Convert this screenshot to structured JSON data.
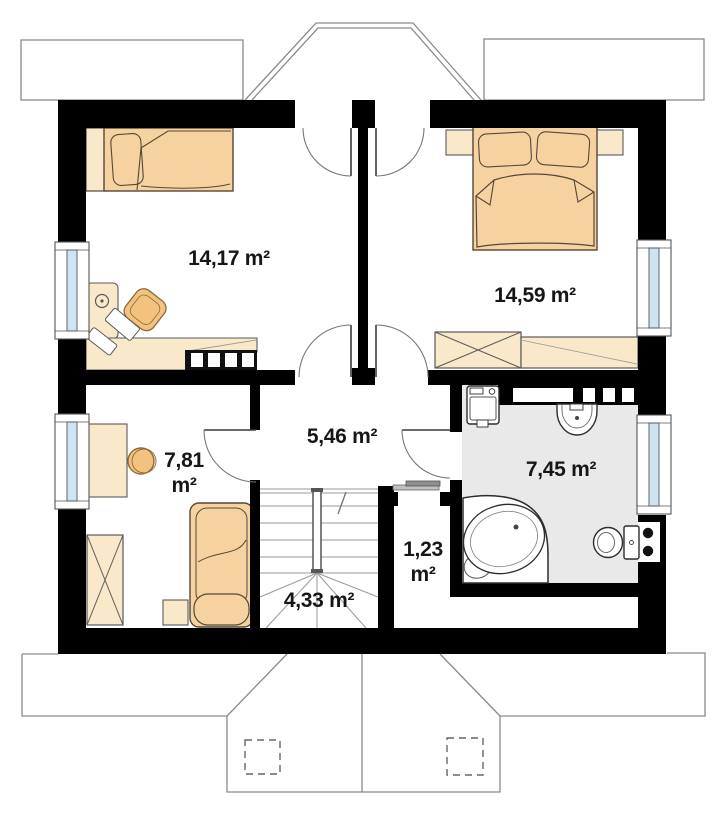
{
  "plan": {
    "rooms": [
      {
        "key": "bedroom-left",
        "area": "14,17 m²"
      },
      {
        "key": "bedroom-right",
        "area": "14,59 m²"
      },
      {
        "key": "hallway",
        "area": "5,46 m²"
      },
      {
        "key": "cabinet-room",
        "area_value": "7,81",
        "area_unit": "m²"
      },
      {
        "key": "staircase",
        "area": "4,33 m²"
      },
      {
        "key": "closet",
        "area_value": "1,23",
        "area_unit": "m²"
      },
      {
        "key": "bathroom",
        "area": "7,45 m²"
      }
    ],
    "colors": {
      "wall": "#000000",
      "furniture_light": "#FAE8CA",
      "furniture_orange": "#F6D2A0",
      "chair_orange": "#F3C27E",
      "bathroom_floor": "#E9E9E9",
      "window_glazing": "#CFE4F2",
      "roof_line": "#8A8A8A",
      "label_text": "#161616"
    }
  }
}
